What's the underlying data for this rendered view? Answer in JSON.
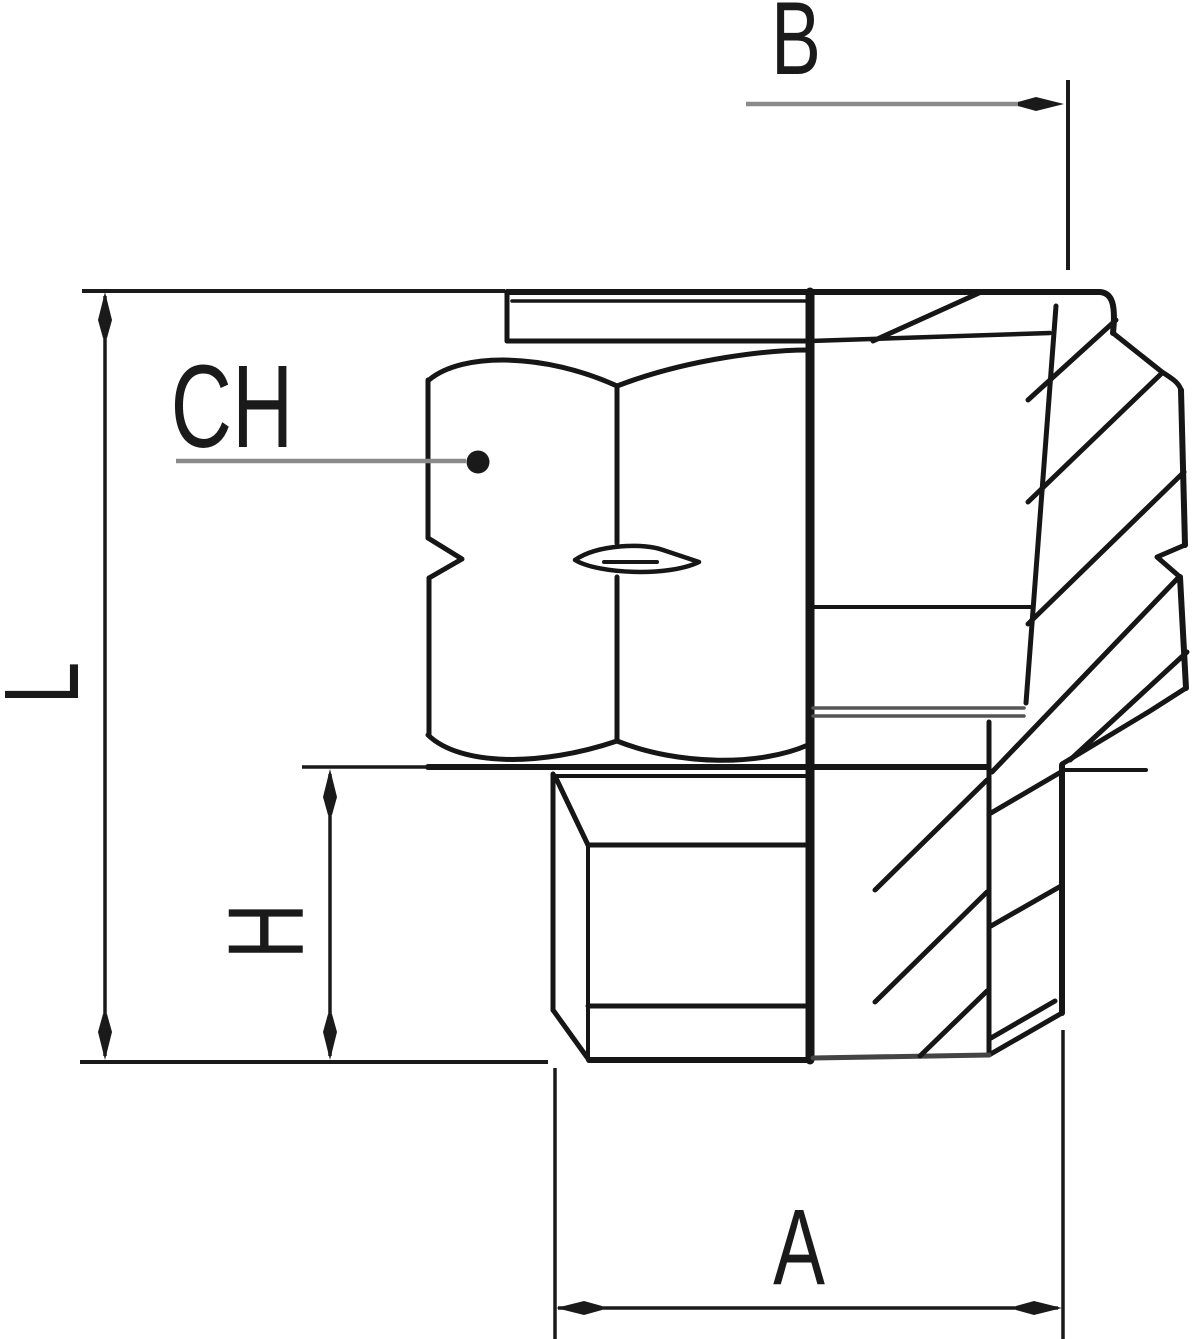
{
  "colors": {
    "ink": "#161616",
    "dimension_line_gray": "#8a8a8a",
    "thin_dim_black": "#1a1a1a",
    "background": "#ffffff"
  },
  "dimensions": {
    "B": {
      "label": "B"
    },
    "CH": {
      "label": "CH"
    },
    "L": {
      "label": "L"
    },
    "H": {
      "label": "H"
    },
    "A": {
      "label": "A"
    }
  }
}
